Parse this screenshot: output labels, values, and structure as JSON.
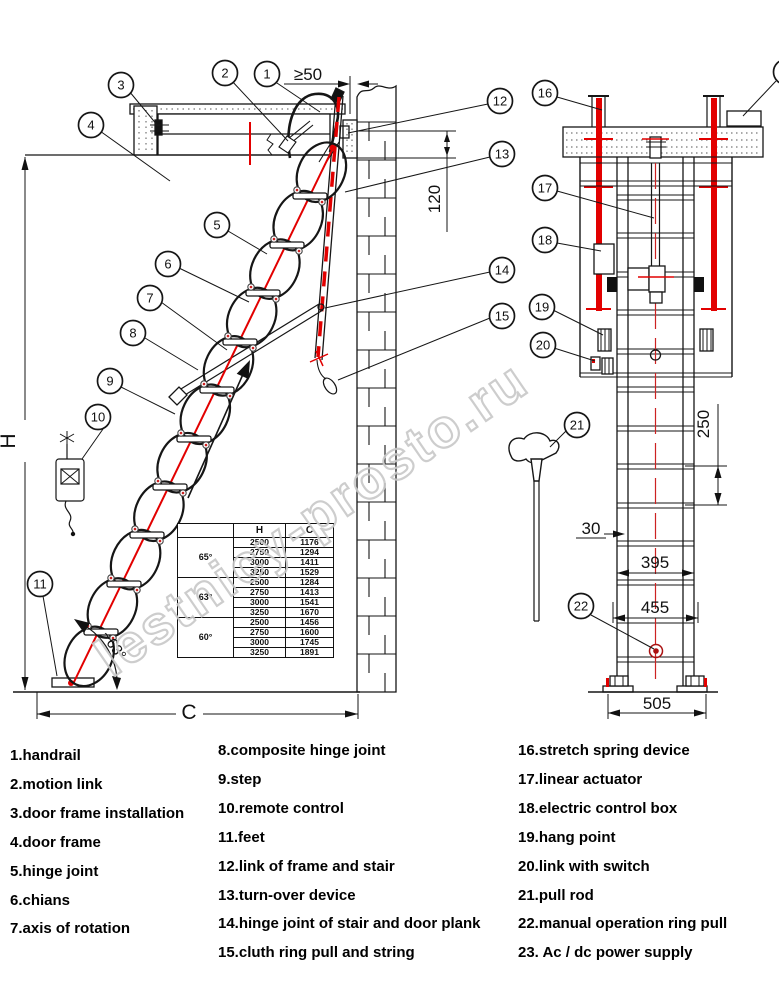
{
  "watermark": "lestnicy-prosto.ru",
  "callouts": {
    "c1": "1",
    "c2": "2",
    "c3": "3",
    "c4": "4",
    "c5": "5",
    "c6": "6",
    "c7": "7",
    "c8": "8",
    "c9": "9",
    "c10": "10",
    "c11": "11",
    "c12": "12",
    "c13": "13",
    "c14": "14",
    "c15": "15",
    "c16": "16",
    "c17": "17",
    "c18": "18",
    "c19": "19",
    "c20": "20",
    "c21": "21",
    "c22": "22"
  },
  "dims": {
    "gap": "≥50",
    "thickness": "120",
    "height": "H",
    "width": "C",
    "angle": "~63°",
    "pitch": "250",
    "depth": "30",
    "inner": "395",
    "outer": "455",
    "base": "505"
  },
  "table": {
    "headers": [
      "",
      "H",
      "C"
    ],
    "groups": [
      {
        "angle": "65°",
        "rows": [
          [
            "2500",
            "1176"
          ],
          [
            "2750",
            "1294"
          ],
          [
            "3000",
            "1411"
          ],
          [
            "3250",
            "1529"
          ]
        ]
      },
      {
        "angle": "63°",
        "rows": [
          [
            "2500",
            "1284"
          ],
          [
            "2750",
            "1413"
          ],
          [
            "3000",
            "1541"
          ],
          [
            "3250",
            "1670"
          ]
        ]
      },
      {
        "angle": "60°",
        "rows": [
          [
            "2500",
            "1456"
          ],
          [
            "2750",
            "1600"
          ],
          [
            "3000",
            "1745"
          ],
          [
            "3250",
            "1891"
          ]
        ]
      }
    ]
  },
  "legend": {
    "col1": [
      "1.handrail",
      "2.motion link",
      "3.door frame installation",
      "4.door frame",
      "5.hinge joint",
      "6.chians",
      "7.axis of rotation"
    ],
    "col2": [
      "8.composite hinge joint",
      "9.step",
      "10.remote control",
      "11.feet",
      "12.link of frame and stair",
      "13.turn-over device",
      "14.hinge joint of stair and door plank",
      "15.cluth ring pull and string"
    ],
    "col3": [
      "16.stretch spring device",
      "17.linear actuator",
      "18.electric control box",
      "19.hang point",
      "20.link with switch",
      "21.pull rod",
      "22.manual operation ring pull",
      "23. Ac / dc power supply"
    ]
  },
  "colors": {
    "accent_red": "#e20000",
    "centerline_red": "#cc2222",
    "watermark_gray": "#c8c8c8",
    "line_black": "#161616"
  }
}
